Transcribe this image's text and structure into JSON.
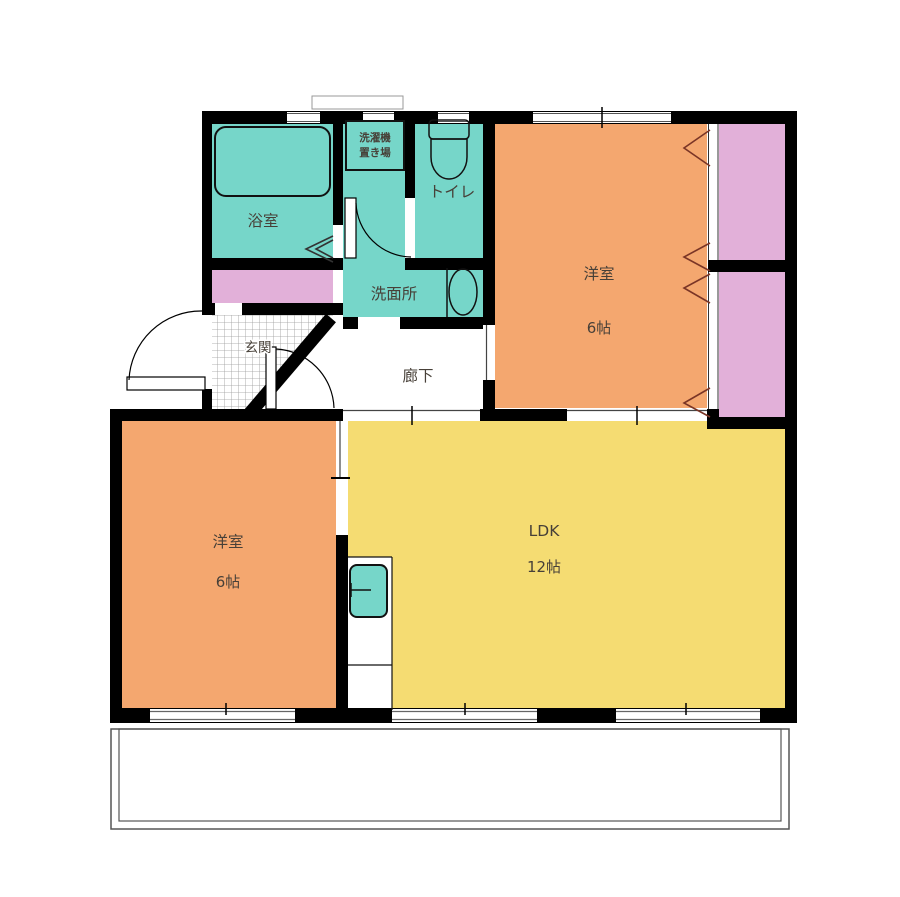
{
  "plan": {
    "type": "floor-plan",
    "rooms": {
      "bathroom": {
        "label": "浴室"
      },
      "washer": {
        "label_line1": "洗濯機",
        "label_line2": "置き場"
      },
      "toilet": {
        "label": "トイレ"
      },
      "washroom": {
        "label": "洗面所"
      },
      "entrance": {
        "label": "玄関"
      },
      "hallway": {
        "label": "廊下"
      },
      "bedroom1": {
        "label": "洋室",
        "size": "6帖"
      },
      "bedroom2": {
        "label": "洋室",
        "size": "6帖"
      },
      "ldk": {
        "label": "LDK",
        "size": "12帖"
      }
    }
  },
  "colors": {
    "wall": "#000000",
    "water_teal": "#76d6c9",
    "room_orange": "#f4a76f",
    "ldk_yellow": "#f5dc72",
    "closet_pink": "#e2b0d9",
    "chevron_brown": "#7a3526",
    "label_text": "#474038",
    "tile_line": "#9a9a9a",
    "window_line": "#555555",
    "balcony_line": "#555555"
  }
}
